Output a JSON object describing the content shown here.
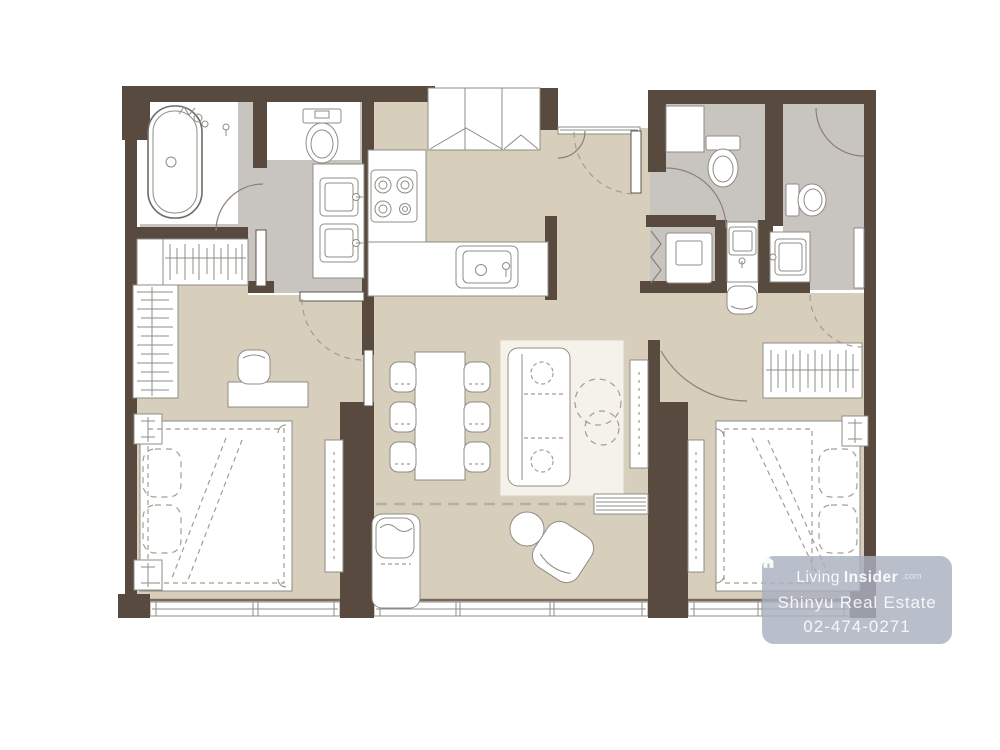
{
  "watermark": {
    "brand_light": "Living",
    "brand_bold": "Insider",
    "brand_suffix": ".com",
    "agency": "Shinyu Real Estate",
    "phone": "02-474-0271",
    "bg_color": "#aab0bf",
    "text_color": "#ffffff"
  },
  "palette": {
    "background": "#ffffff",
    "wall": "#584a3e",
    "floor": "#d7cebc",
    "bath_floor": "#c8c5c0",
    "fixture_fill": "#ffffff",
    "fixture_line": "#8e8c85",
    "dash_line": "#a39d92",
    "rug": "#f5f2ea"
  }
}
